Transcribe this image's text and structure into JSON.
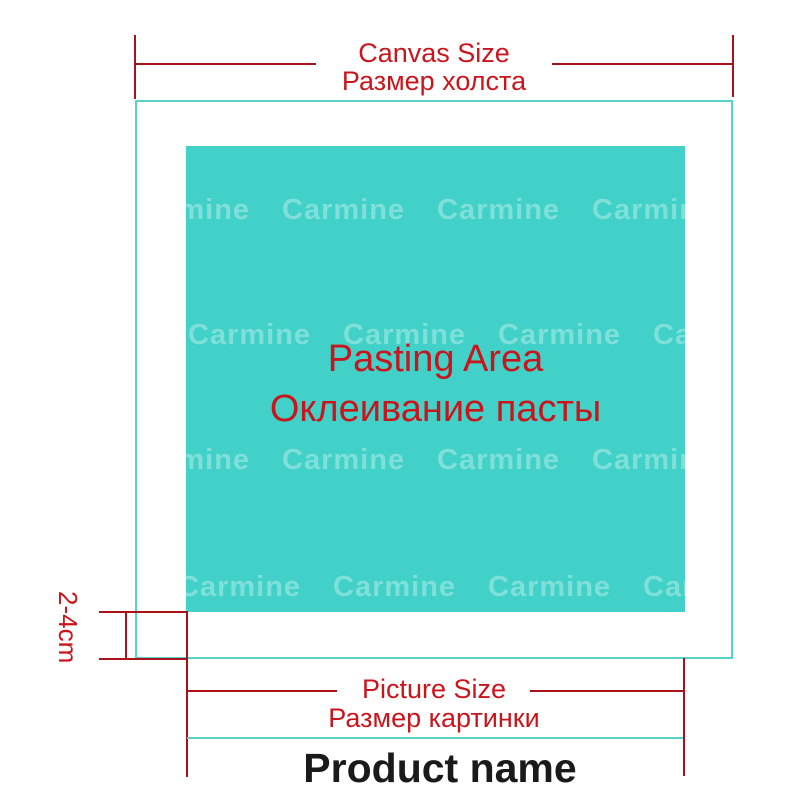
{
  "colors": {
    "background": "#ffffff",
    "teal_fill": "#41d1c8",
    "teal_line": "#55d2cb",
    "red_line": "#aa1219",
    "red_text": "#c9151b",
    "product_text": "#1a1a1a",
    "watermark_text": "rgba(255,255,255,0.32)"
  },
  "canvas_dimension": {
    "label_en": "Canvas Size",
    "label_ru": "Размер холста"
  },
  "pasting_area": {
    "label_en": "Pasting Area",
    "label_ru": "Оклеивание пасты"
  },
  "margin_dimension": {
    "label": "2-4cm"
  },
  "picture_dimension": {
    "label_en": "Picture Size",
    "label_ru": "Размер картинки"
  },
  "product": {
    "label": "Product name"
  },
  "watermark": {
    "text": "Carmine",
    "pitch": 155,
    "per_row": 5,
    "rows": [
      {
        "x": -59,
        "y": 48
      },
      {
        "x": 2,
        "y": 173
      },
      {
        "x": -59,
        "y": 298
      },
      {
        "x": -8,
        "y": 425
      }
    ]
  }
}
